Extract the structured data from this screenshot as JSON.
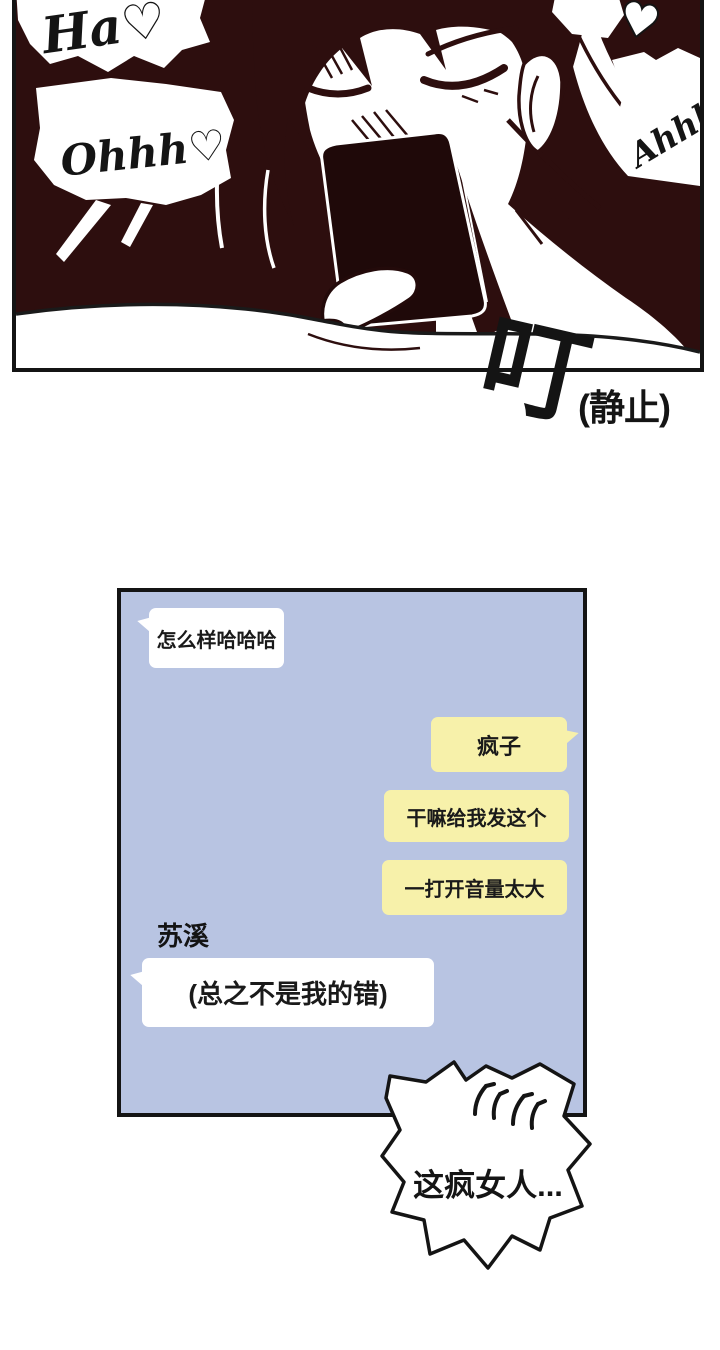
{
  "colors": {
    "panel_background": "#2d0e0e",
    "chat_background": "#b8c4e2",
    "bubble_yellow": "#f7f1aa",
    "bubble_white": "#ffffff",
    "ink": "#141414"
  },
  "panel": {
    "bubble_ha": "Ha♡",
    "bubble_ohhh": "Ohhh♡",
    "bubble_ahhh": "Ahhh!?",
    "heart_icon": "♥"
  },
  "sfx": {
    "ding": "叮",
    "caption": "(静止)"
  },
  "chat": {
    "sender_label": "苏溪",
    "messages": [
      {
        "side": "left",
        "style": "white",
        "text": "怎么样哈哈哈"
      },
      {
        "side": "right",
        "style": "yellow",
        "text": "疯子"
      },
      {
        "side": "right",
        "style": "yellow",
        "text": "干嘛给我发这个"
      },
      {
        "side": "right",
        "style": "yellow",
        "text": "一打开音量太大"
      },
      {
        "side": "left",
        "style": "white",
        "text": "(总之不是我的错)"
      }
    ]
  },
  "burst": {
    "text": "这疯女人...",
    "anger_icon": "💢"
  }
}
